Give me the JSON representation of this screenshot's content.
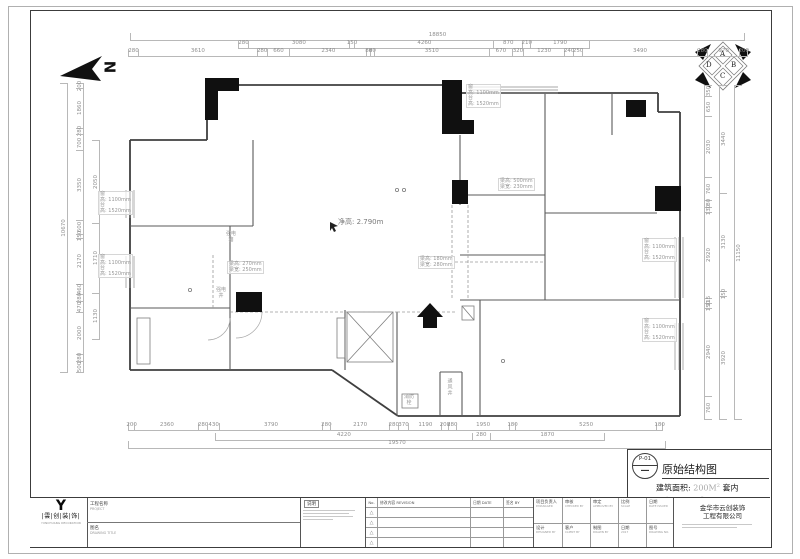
{
  "sheet_title": "原始结构图",
  "pbox": {
    "no": "P-01",
    "dash": "—",
    "title": "原始结构图",
    "area_l1a": "建筑面积:",
    "area_l1b": "200M",
    "area_l1c": "套内",
    "area_l2a": "面积:",
    "area_l2b": "175M",
    "sup": "2"
  },
  "labels": {
    "clear_height": "净高: 2.790m",
    "window": {
      "w1": "窗",
      "w2": "高: 1100mm",
      "w3": "台",
      "w4": "高: 1520mm"
    },
    "beam1": {
      "l1": "梁高: 270mm",
      "l2": "梁宽: 250mm"
    },
    "beam2": {
      "l1": "梁高: 180mm",
      "l2": "梁宽: 280mm"
    },
    "beam3": {
      "l1": "梁高: 500mm",
      "l2": "梁宽: 230mm"
    },
    "power_box_l1": "强电",
    "power_box_l2": "箱",
    "power_shaft_l1": "强电",
    "power_shaft_l2": "井",
    "vent_shaft": "通风井",
    "hydrant_l1": "消防",
    "hydrant_l2": "栓",
    "north": "N"
  },
  "compass": {
    "a": "A",
    "b": "B",
    "c": "C",
    "d": "D"
  },
  "dims": {
    "top1": [
      "18850"
    ],
    "top2": [
      "280",
      "3080",
      "150",
      "4260",
      "870",
      "210",
      "1790"
    ],
    "top3": [
      "280",
      "3610",
      "280",
      "660",
      "2340",
      "80",
      "80",
      "3510",
      "670",
      "320",
      "1230",
      "240",
      "250",
      "3490",
      "280",
      "970",
      "200"
    ],
    "left_outer": [
      "10670"
    ],
    "left_mid": [
      "200",
      "1860",
      "280",
      "700",
      "3350",
      "600",
      "150",
      "2170",
      "460",
      "280",
      "470",
      "2000",
      "280",
      "500"
    ],
    "left_inner": [
      "2050",
      "1710",
      "1130"
    ],
    "right_inner": [
      "350",
      "650",
      "2030",
      "760",
      "180",
      "130",
      "2920",
      "115",
      "150",
      "2940",
      "760"
    ],
    "right_mid": [
      "3440",
      "3130",
      "150",
      "3920"
    ],
    "right_outer": [
      "11150"
    ],
    "bottom1": [
      "200",
      "2360",
      "280",
      "430",
      "3790",
      "280",
      "2170",
      "280",
      "370",
      "1190",
      "200",
      "280",
      "1950",
      "180",
      "5250",
      "180"
    ],
    "bottom2": [
      "4220",
      "280",
      "1870"
    ],
    "bottom3": [
      "19570"
    ]
  },
  "titleblock": {
    "logo_mark": "Y",
    "logo_text": "|雲|创|装|饰|",
    "logo_sub": "YUNCHUANG DECORATION",
    "project_label_cn": "工程名称",
    "project_label_en": "PROJECT",
    "drawing_label_cn": "图名",
    "drawing_label_en": "DRAWING TITLE",
    "notes_title": "说明",
    "rev_no": "No.",
    "rev_content": "修改内容 REVISION",
    "rev_date": "日期 DATE",
    "rev_by": "签名 BY",
    "rev_icon": "△",
    "grid": {
      "r1": [
        {
          "cn": "项目负责人",
          "en": "P.MANAGER"
        },
        {
          "cn": "审核",
          "en": "CHECKED BY"
        },
        {
          "cn": "审定",
          "en": "APPROVED BY"
        },
        {
          "cn": "比例",
          "en": "SCALE"
        },
        {
          "cn": "日期",
          "en": "DATE ISSUED"
        }
      ],
      "r2": [
        {
          "cn": "设计",
          "en": "DESIGNED BY"
        },
        {
          "cn": "客户",
          "en": "CLIENT BY"
        },
        {
          "cn": "制图",
          "en": "DRAWN BY"
        },
        {
          "cn": "日期",
          "en": "2017"
        },
        {
          "cn": "图号",
          "en": "DRAWING NO."
        }
      ]
    },
    "company_line1": "金华市云创装饰",
    "company_line2": "工程有限公司"
  }
}
